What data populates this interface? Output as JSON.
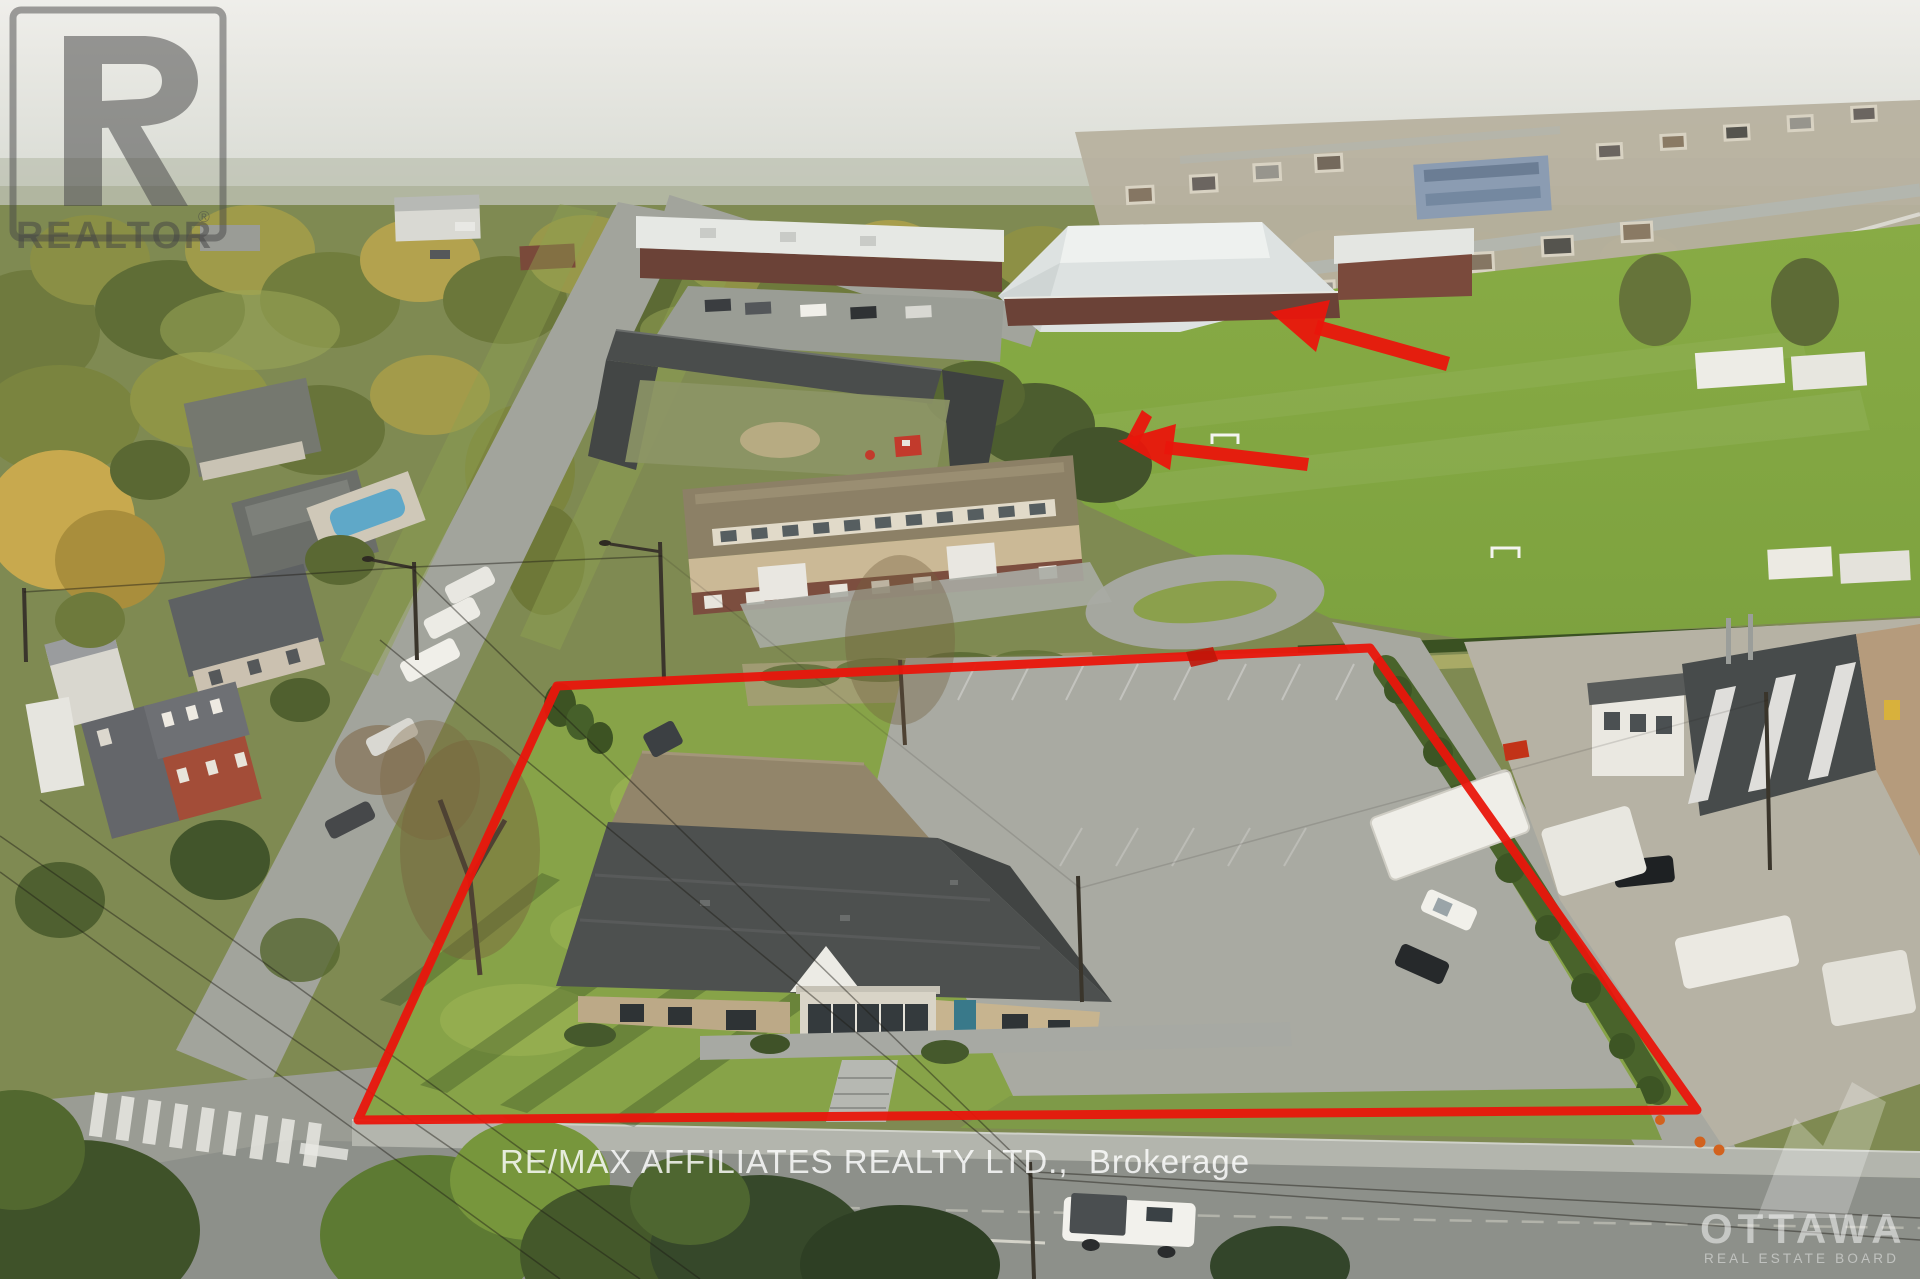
{
  "watermarks": {
    "realtor_logo": {
      "label": "REALTOR",
      "registered_mark": "®"
    },
    "brokerage_line": "RE/MAX AFFILIATES REALTY LTD.,  Brokerage",
    "board_logo": {
      "name": "OTTAWA",
      "subtitle": "REAL ESTATE BOARD"
    }
  },
  "annotations": {
    "accent_red": "#e9160c",
    "accent_red_dark": "#c01509",
    "watermark_gray": "#454545",
    "watermark_white": "#ffffff",
    "property_outline_points": "557,686 1370,648 1697,1110 358,1120",
    "boundary_tick_points": "1186,652 1213,647 1218,661 1191,667",
    "arrow_far": {
      "shaft_points": "1450,357 1446,371 1314,334 1318,320",
      "head_points": "1270,312 1330,300 1316,352"
    },
    "arrow_near": {
      "shaft_points": "1309,458 1307,471 1164,454 1166,441",
      "head_points": "1118,441 1176,424 1170,470",
      "barb_points": "1152,417 1142,410 1126,440 1137,447"
    }
  }
}
